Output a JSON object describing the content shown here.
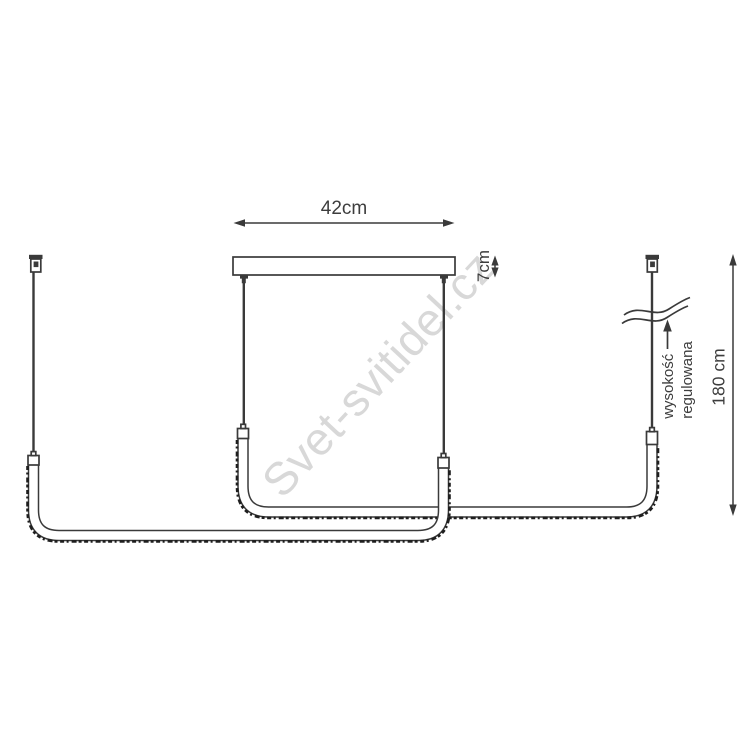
{
  "diagram": {
    "type": "pendant-lamp-dimension-drawing",
    "labels": {
      "canopy_width": "42cm",
      "canopy_height": "7cm",
      "suspension_height": "180 cm",
      "adjustable_line1": "wysokość",
      "adjustable_line2": "regulowana"
    },
    "watermark": "Svet-svitidel.cz",
    "colors": {
      "line": "#3a3a3a",
      "text": "#3d3d3d",
      "texture": "#1f1f1f",
      "watermark": "#d8d8d8",
      "background": "#ffffff"
    }
  }
}
